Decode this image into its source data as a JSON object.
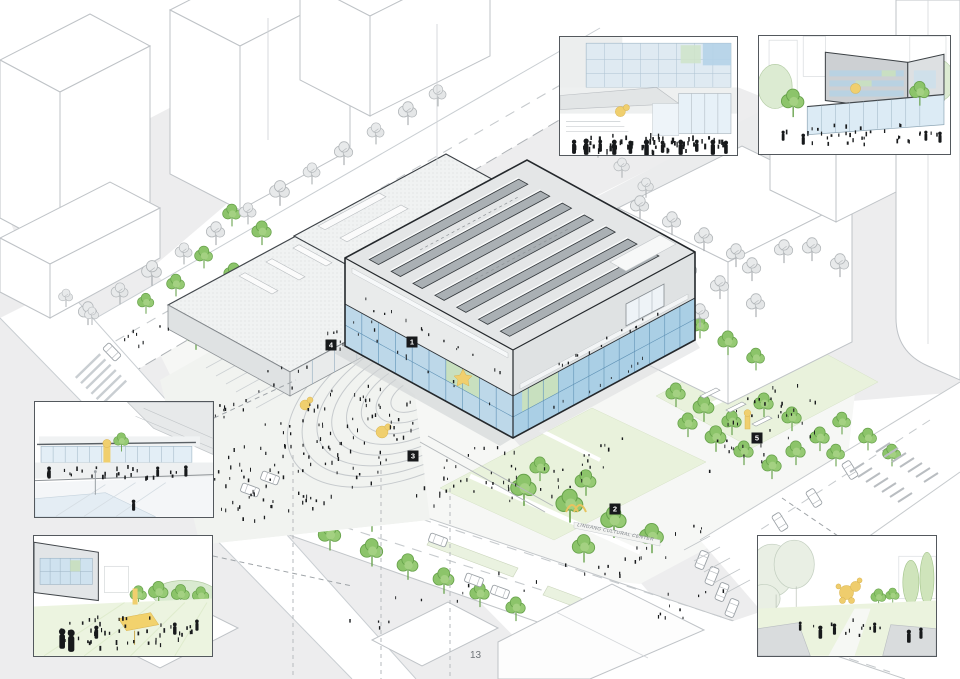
{
  "page": {
    "number": "13"
  },
  "plan": {
    "sign_text": "LINGANG CULTURAL CENTER",
    "markers": [
      {
        "label": "1"
      },
      {
        "label": "2"
      },
      {
        "label": "3"
      },
      {
        "label": "4"
      },
      {
        "label": "5"
      }
    ]
  },
  "colors": {
    "accent_yellow": "#f0cf6e",
    "tree_green": "#8cc46a",
    "tree_green_stroke": "#67a24b",
    "sketch_tree_grey": "#d9dbdc",
    "glass_blue": "#b7d6e9",
    "glass_green": "#cfe3c6",
    "line_grey": "#b9bdc1",
    "dark_edge": "#2e3236",
    "ground_grey": "#ececed",
    "lawn_green": "#e9f2dc",
    "people_black": "#1a1c1e",
    "marker_bg": "#17191b",
    "marker_fg": "#ffffff"
  }
}
